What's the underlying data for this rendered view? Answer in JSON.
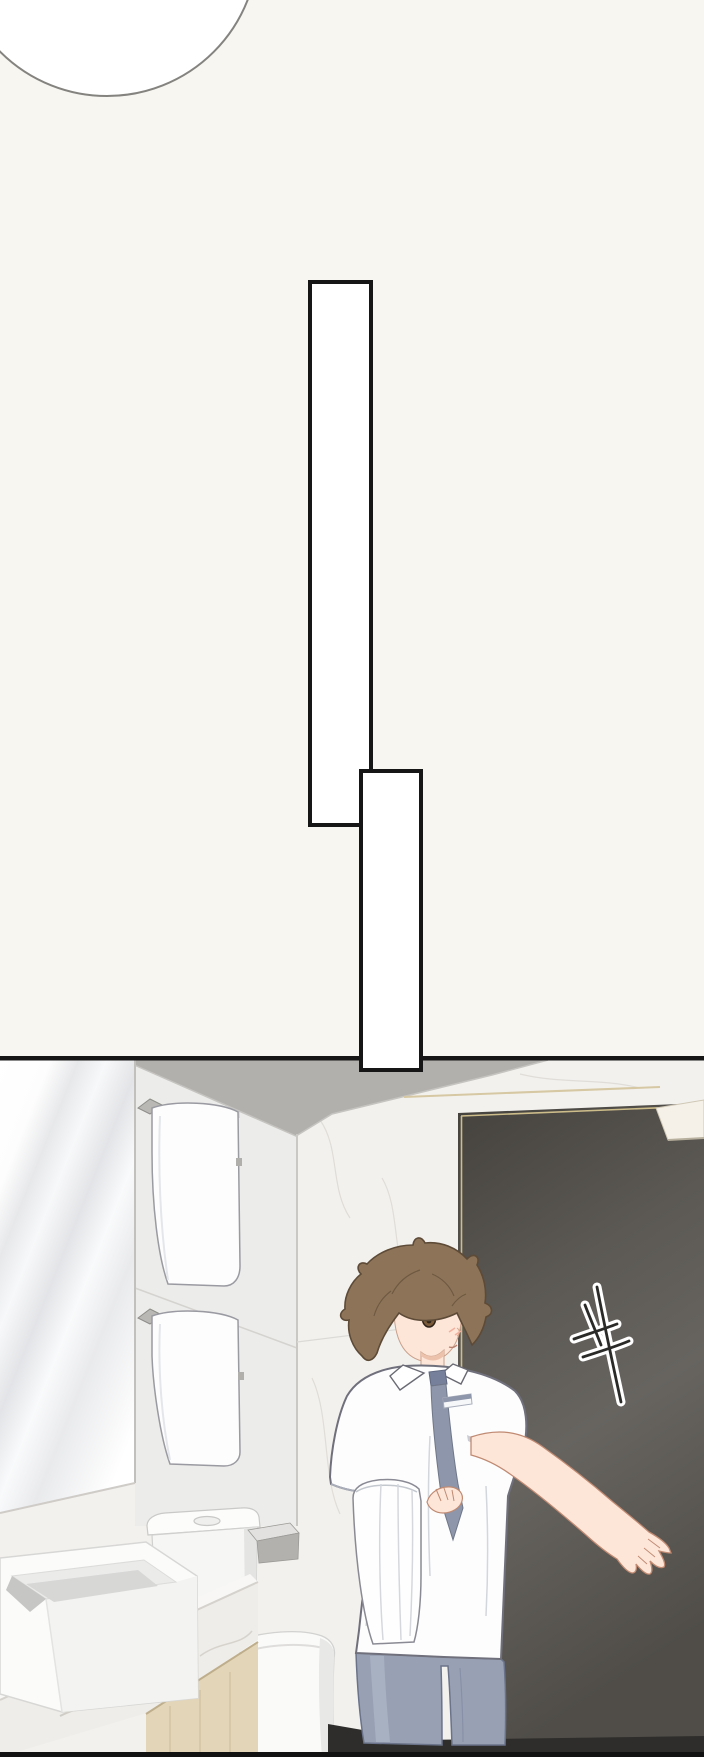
{
  "meta": {
    "kind": "webtoon comic page",
    "scene": "bathroom scene: boy in white shirt and tie holding a towel, reaching toward a dark door with a handwritten mark"
  },
  "speech_bubbles": [
    {
      "text": ""
    },
    {
      "text": ""
    }
  ],
  "door_sign": {
    "label": "handwritten brush mark on door"
  },
  "colors": {
    "bg": "#f8f6f1",
    "ink": "#161616",
    "bubble_fill": "#ffffff",
    "panel_wall": "#f3f1ee",
    "ceiling": "#b2b0ad",
    "tile": "#ececea",
    "mirror_edge": "#c2c0bd",
    "gold": "#d2c190",
    "door_dark": "#45423e",
    "door_mid": "#676460",
    "metal": "#a7a5a0",
    "towel": "#fdfdfd",
    "porcelain": "#fafaf9",
    "counter": "#efede9",
    "wood": "#e3d5b8",
    "floor_dark": "#2e2d2b",
    "skin": "#fde6d8",
    "skin_line": "#c08a72",
    "hair": "#8d7458",
    "hair_line": "#5d4a37",
    "shirt": "#fdfdfe",
    "shirt_line": "#70707c",
    "tie": "#8d96aa",
    "pants": "#98a1b4"
  }
}
